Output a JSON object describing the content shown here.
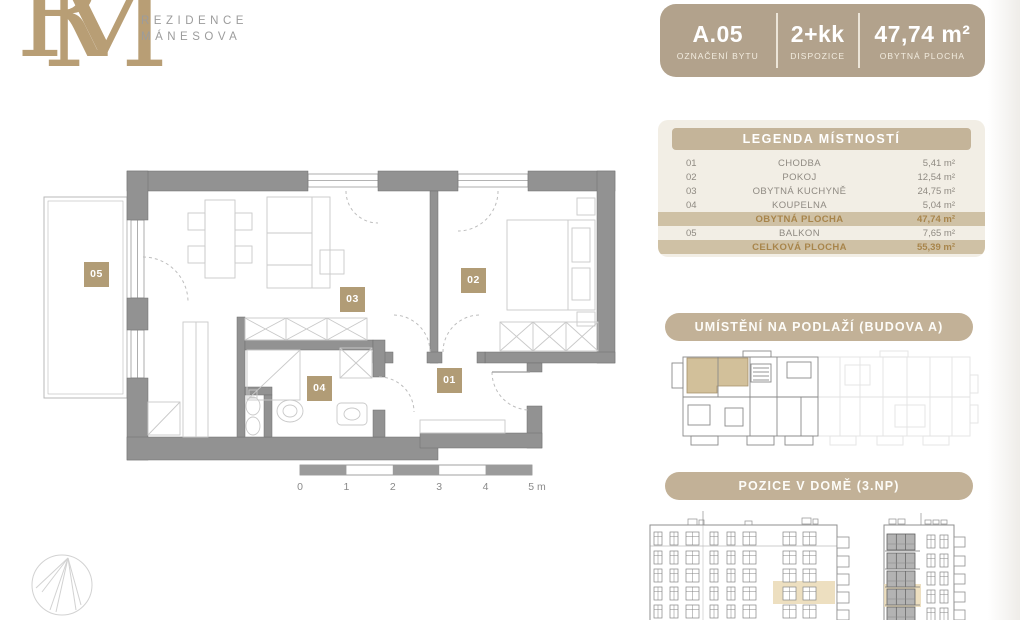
{
  "logo": {
    "monogram_r": "R",
    "monogram_m": "M",
    "brand_line1": "REZIDENCE",
    "brand_line2": "MÁNESOVA"
  },
  "badge": {
    "items": [
      {
        "value": "A.05",
        "label": "OZNAČENÍ BYTU"
      },
      {
        "value": "2+kk",
        "label": "DISPOZICE"
      },
      {
        "value": "47,74 m²",
        "label": "OBYTNÁ PLOCHA"
      }
    ]
  },
  "legend": {
    "title": "LEGENDA MÍSTNOSTÍ",
    "rows": [
      {
        "num": "01",
        "name": "CHODBA",
        "area": "5,41 m²"
      },
      {
        "num": "02",
        "name": "POKOJ",
        "area": "12,54 m²"
      },
      {
        "num": "03",
        "name": "OBYTNÁ KUCHYNĚ",
        "area": "24,75 m²"
      },
      {
        "num": "04",
        "name": "KOUPELNA",
        "area": "5,04 m²"
      },
      {
        "num": "",
        "name": "OBYTNÁ PLOCHA",
        "area": "47,74 m²"
      },
      {
        "num": "05",
        "name": "BALKON",
        "area": "7,65 m²"
      },
      {
        "num": "",
        "name": "CELKOVÁ PLOCHA",
        "area": "55,39 m²"
      }
    ]
  },
  "sections": {
    "floor_location": "UMÍSTĚNÍ NA PODLAŽÍ (BUDOVA A)",
    "house_position": "POZICE V DOMĚ (3.NP)"
  },
  "plan": {
    "room_labels": [
      "01",
      "02",
      "03",
      "04",
      "05"
    ],
    "scale_ticks": [
      "0",
      "1",
      "2",
      "3",
      "4",
      "5 m"
    ]
  },
  "colors": {
    "accent_tan": "#b2a28c",
    "header_bar": "#c4b499",
    "highlight_row_bg": "#cfc1a5",
    "highlight_row_text": "#a8854b",
    "room_label_bg": "#b19c76",
    "plan_wall": "#929292",
    "panel_bg": "#f2eee5",
    "drawing_highlight": "#ead9b5"
  }
}
